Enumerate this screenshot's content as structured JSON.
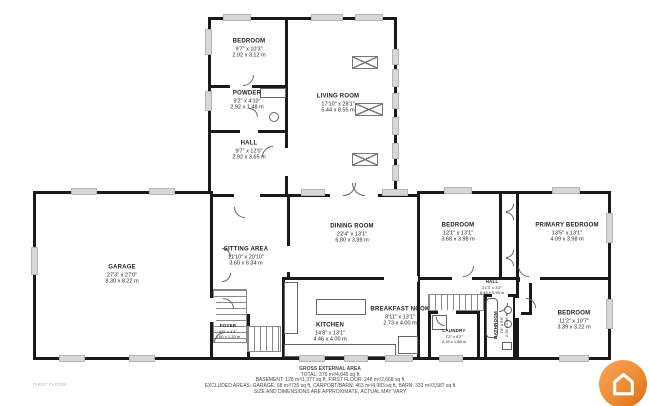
{
  "meta": {
    "floor_label": "FIRST FLOOR"
  },
  "footer": {
    "title": "GROSS EXTERNAL AREA",
    "total": "TOTAL: 376 m²/4,045 sq ft",
    "line2": "BASEMENT: 128 m²/1,377 sq ft, FIRST FLOOR: 248 m²/2,668 sq ft",
    "line3": "EXCLUDED AREAS: GARAGE: 68 m²/735 sq ft, CARPORT/BARN: 463 m²/4,983 sq ft, BARN: 333 m²/3,587 sq ft",
    "disclaimer": "SIZE AND DIMENSIONS ARE APPROXIMATE, ACTUAL MAY VARY"
  },
  "logo": {
    "accent_color": "#ee8c34",
    "icon": "house-icon"
  },
  "rooms": [
    {
      "id": "bedroom-top",
      "name": "BEDROOM",
      "imperial": "9'7\" x 10'3\"",
      "metric": "2.92 x 3.12 m"
    },
    {
      "id": "powder",
      "name": "POWDER",
      "imperial": "9'2\" x 4'10\"",
      "metric": "2.92 x 1.48 m"
    },
    {
      "id": "hall-top",
      "name": "HALL",
      "imperial": "9'7\" x 12'0\"",
      "metric": "2.92 x 3.65 m"
    },
    {
      "id": "living-room",
      "name": "LIVING ROOM",
      "imperial": "17'10\" x 28'1\"",
      "metric": "5.44 x 8.55 m"
    },
    {
      "id": "garage",
      "name": "GARAGE",
      "imperial": "27'3\" x 27'0\"",
      "metric": "8.30 x 8.22 m"
    },
    {
      "id": "sitting-area",
      "name": "SITTING AREA",
      "imperial": "11'10\" x 20'10\"",
      "metric": "3.60 x 6.34 m"
    },
    {
      "id": "foyer",
      "name": "FOYER",
      "imperial": "5'9\" x 4'4\"",
      "metric": "1.80 x 1.33 m"
    },
    {
      "id": "dining-room",
      "name": "DINING ROOM",
      "imperial": "22'4\" x 13'1\"",
      "metric": "6.80 x 3.98 m"
    },
    {
      "id": "kitchen",
      "name": "KITCHEN",
      "imperial": "14'8\" x 13'1\"",
      "metric": "4.46 x 4.00 m"
    },
    {
      "id": "breakfast-nook",
      "name": "BREAKFAST NOOK",
      "imperial": "8'11\" x 13'1\"",
      "metric": "2.73 x 4.00 m"
    },
    {
      "id": "bedroom-mid",
      "name": "BEDROOM",
      "imperial": "12'1\" x 13'1\"",
      "metric": "3.68 x 3.98 m"
    },
    {
      "id": "primary-bedroom",
      "name": "PRIMARY BEDROOM",
      "imperial": "13'5\" x 13'1\"",
      "metric": "4.09 x 3.98 m"
    },
    {
      "id": "hall-right",
      "name": "HALL",
      "imperial": "21'3\" x 3'2\"",
      "metric": "6.49 x 0.95 m"
    },
    {
      "id": "laundry",
      "name": "LAUNDRY",
      "imperial": "7'2\" x 6'2\"",
      "metric": "2.19 x 1.88 m"
    },
    {
      "id": "bathroom",
      "name": "BATHROOM",
      "imperial": "7'8\" x 9'6\"",
      "metric": "2.34 x 2.89 m"
    },
    {
      "id": "bedroom-br",
      "name": "BEDROOM",
      "imperial": "11'2\" x 10'7\"",
      "metric": "3.39 x 3.22 m"
    }
  ]
}
